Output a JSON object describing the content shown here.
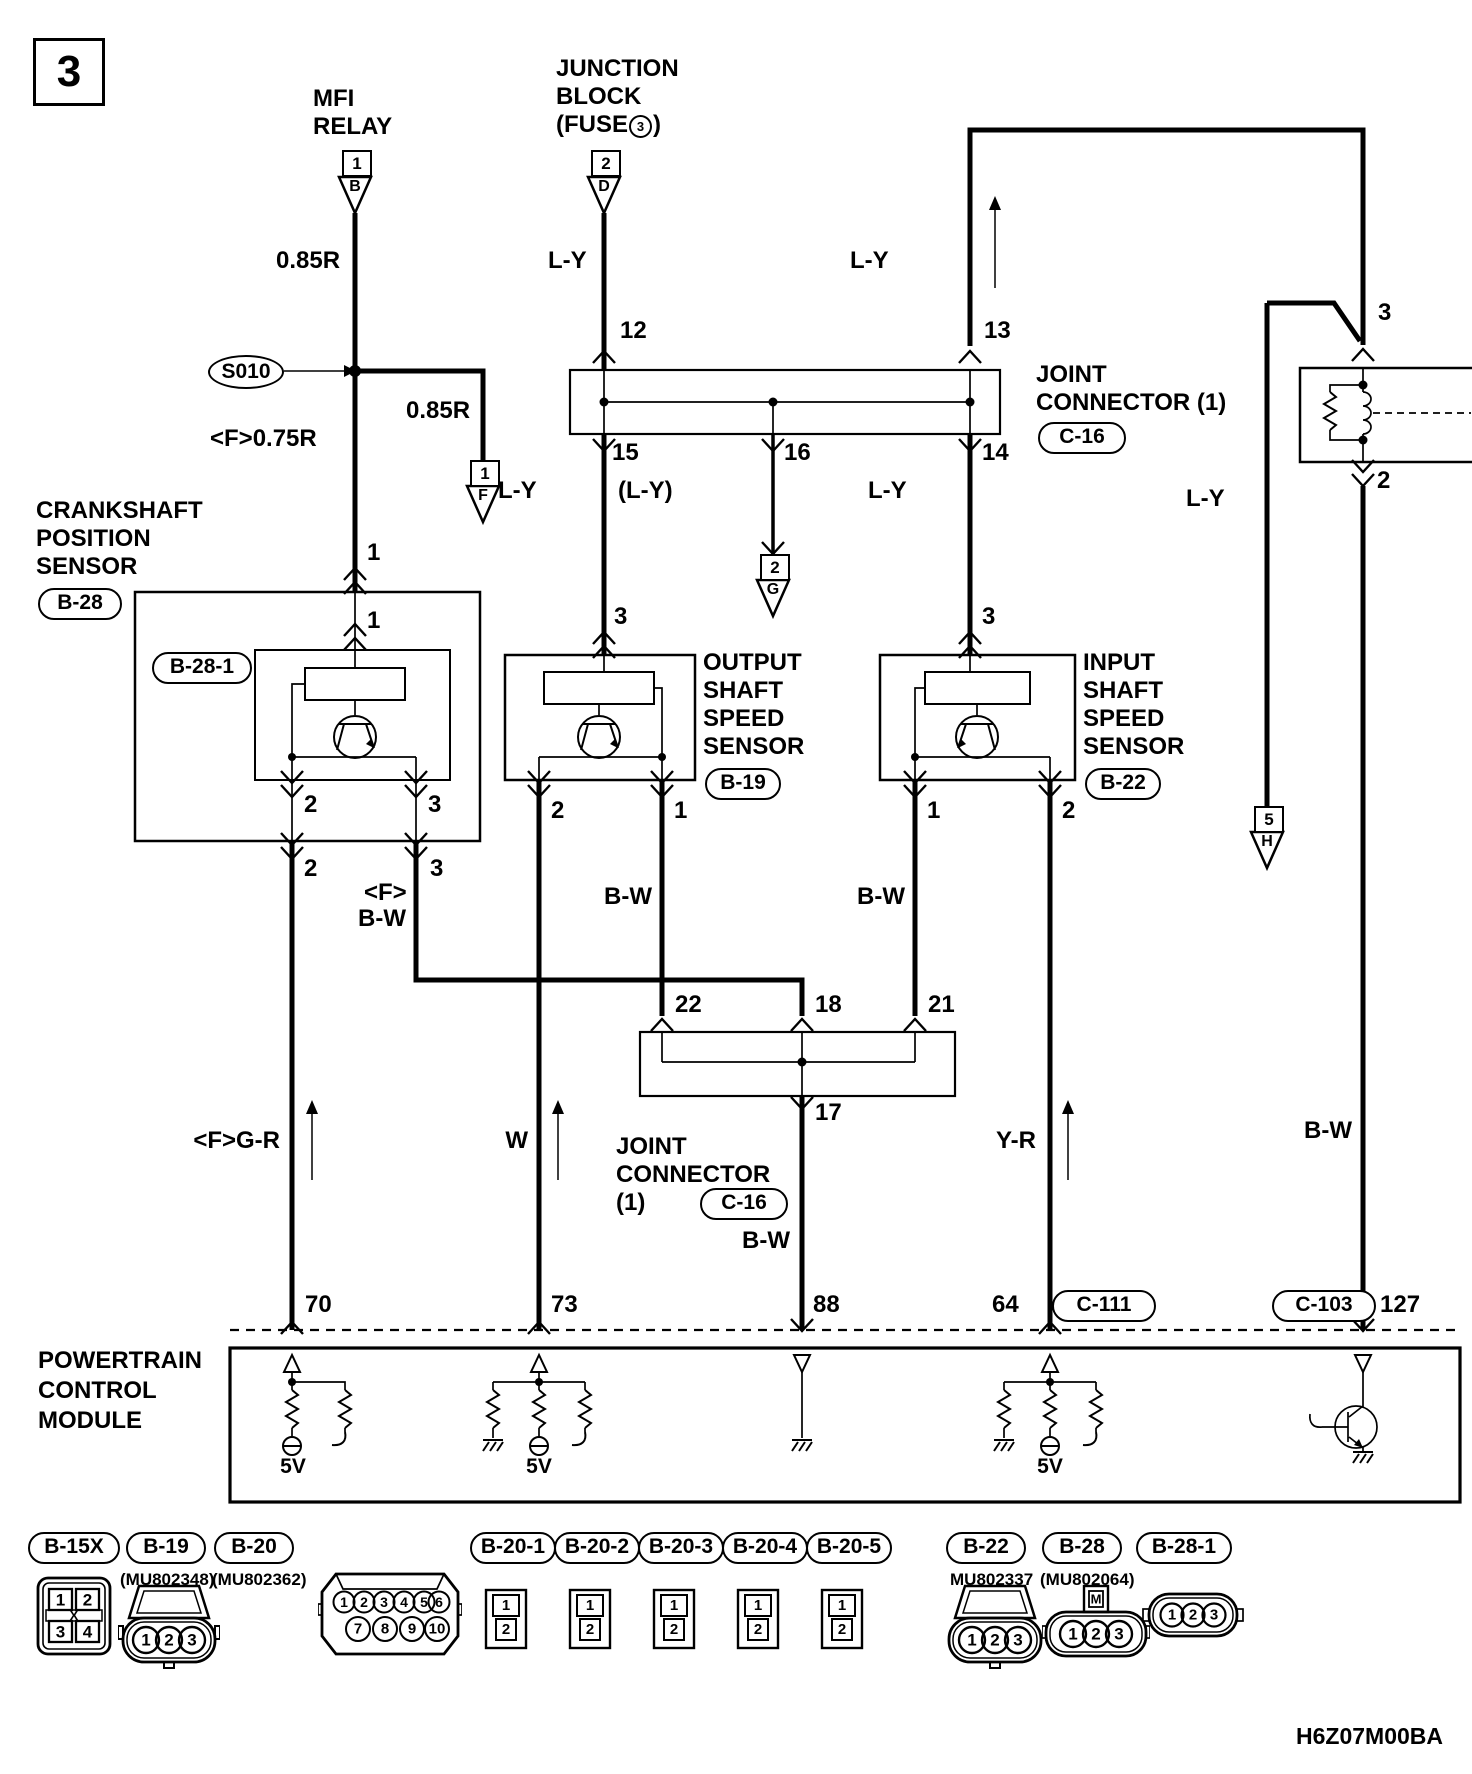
{
  "page": {
    "sheet_number": "3",
    "doc_code": "H6Z07M00BA"
  },
  "titles": {
    "mfi_relay": [
      "MFI",
      "RELAY"
    ],
    "junction_block": [
      "JUNCTION",
      "BLOCK"
    ],
    "fuse_prefix": "(FUSE",
    "fuse_number": "3",
    "fuse_suffix": ")",
    "crank_sensor": [
      "CRANKSHAFT",
      "POSITION",
      "SENSOR"
    ],
    "output_sensor": [
      "OUTPUT",
      "SHAFT",
      "SPEED",
      "SENSOR"
    ],
    "input_sensor": [
      "INPUT",
      "SHAFT",
      "SPEED",
      "SENSOR"
    ],
    "pcm": [
      "POWERTRAIN",
      "CONTROL",
      "MODULE"
    ],
    "jc1_line1": "JOINT",
    "jc1_line2": "CONNECTOR (1)",
    "jc2_line1": "JOINT",
    "jc2_line2": "CONNECTOR",
    "jc2_line3": "(1)"
  },
  "refs": {
    "crank": "B-28",
    "crank_sub": "B-28-1",
    "output": "B-19",
    "input": "B-22",
    "jc1": "C-16",
    "jc2": "C-16",
    "pcm_c111": "C-111",
    "pcm_c103": "C-103"
  },
  "splice": "S010",
  "inline_connectors": {
    "b": {
      "num": "1",
      "letter": "B"
    },
    "d": {
      "num": "2",
      "letter": "D"
    },
    "f": {
      "num": "1",
      "letter": "F"
    },
    "g": {
      "num": "2",
      "letter": "G"
    },
    "h": {
      "num": "5",
      "letter": "H"
    }
  },
  "wire_labels": {
    "mfi_feed": "0.85R",
    "mfi_branch": "0.85R",
    "crank_feed": "<F>0.75R",
    "jb_out": "L-Y",
    "jc1_13": "L-Y",
    "jc1_15": "L-Y",
    "jc1_16": "(L-Y)",
    "jc1_14": "L-Y",
    "relay_branch": "L-Y",
    "crank_sig_f": "<F>",
    "crank_sig": "B-W",
    "output_sig": "B-W",
    "input_sig": "B-W",
    "crank_minus": "<F>G-R",
    "output_minus": "W",
    "jc2_out": "B-W",
    "input_minus": "Y-R",
    "relay_out": "B-W"
  },
  "pins": {
    "crank_1_outer": "1",
    "crank_1_inner": "1",
    "crank_2_inner": "2",
    "crank_3_inner": "3",
    "crank_2_outer": "2",
    "crank_3_outer": "3",
    "jc1_12": "12",
    "jc1_13": "13",
    "jc1_15": "15",
    "jc1_16": "16",
    "jc1_14": "14",
    "output_3": "3",
    "output_2": "2",
    "output_1": "1",
    "input_3": "3",
    "input_1": "1",
    "input_2": "2",
    "relay_3": "3",
    "relay_2": "2",
    "jc2_22": "22",
    "jc2_18": "18",
    "jc2_21": "21",
    "jc2_17": "17",
    "pcm_70": "70",
    "pcm_73": "73",
    "pcm_88": "88",
    "pcm_64": "64",
    "pcm_127": "127"
  },
  "pcm_internal": {
    "v5_1": "5V",
    "v5_2": "5V",
    "v5_3": "5V"
  },
  "connector_pinouts": [
    {
      "ref": "B-15X",
      "part": "",
      "pins": [
        "1",
        "2",
        "3",
        "4"
      ],
      "center_mark": "X"
    },
    {
      "ref": "B-19",
      "part": "(MU802348)",
      "pins": [
        "1",
        "2",
        "3"
      ]
    },
    {
      "ref": "B-20",
      "part": "(MU802362)",
      "pins": [
        "1",
        "2",
        "3",
        "4",
        "5",
        "6",
        "7",
        "8",
        "9",
        "10"
      ]
    },
    {
      "ref": "B-20-1",
      "part": "",
      "pins": [
        "1",
        "2"
      ]
    },
    {
      "ref": "B-20-2",
      "part": "",
      "pins": [
        "1",
        "2"
      ]
    },
    {
      "ref": "B-20-3",
      "part": "",
      "pins": [
        "1",
        "2"
      ]
    },
    {
      "ref": "B-20-4",
      "part": "",
      "pins": [
        "1",
        "2"
      ]
    },
    {
      "ref": "B-20-5",
      "part": "",
      "pins": [
        "1",
        "2"
      ]
    },
    {
      "ref": "B-22",
      "part": "MU802337",
      "pins": [
        "1",
        "2",
        "3"
      ]
    },
    {
      "ref": "B-28",
      "part": "(MU802064)",
      "pins": [
        "1",
        "2",
        "3"
      ],
      "tab": "M"
    },
    {
      "ref": "B-28-1",
      "part": "",
      "pins": [
        "1",
        "2",
        "3"
      ]
    }
  ]
}
